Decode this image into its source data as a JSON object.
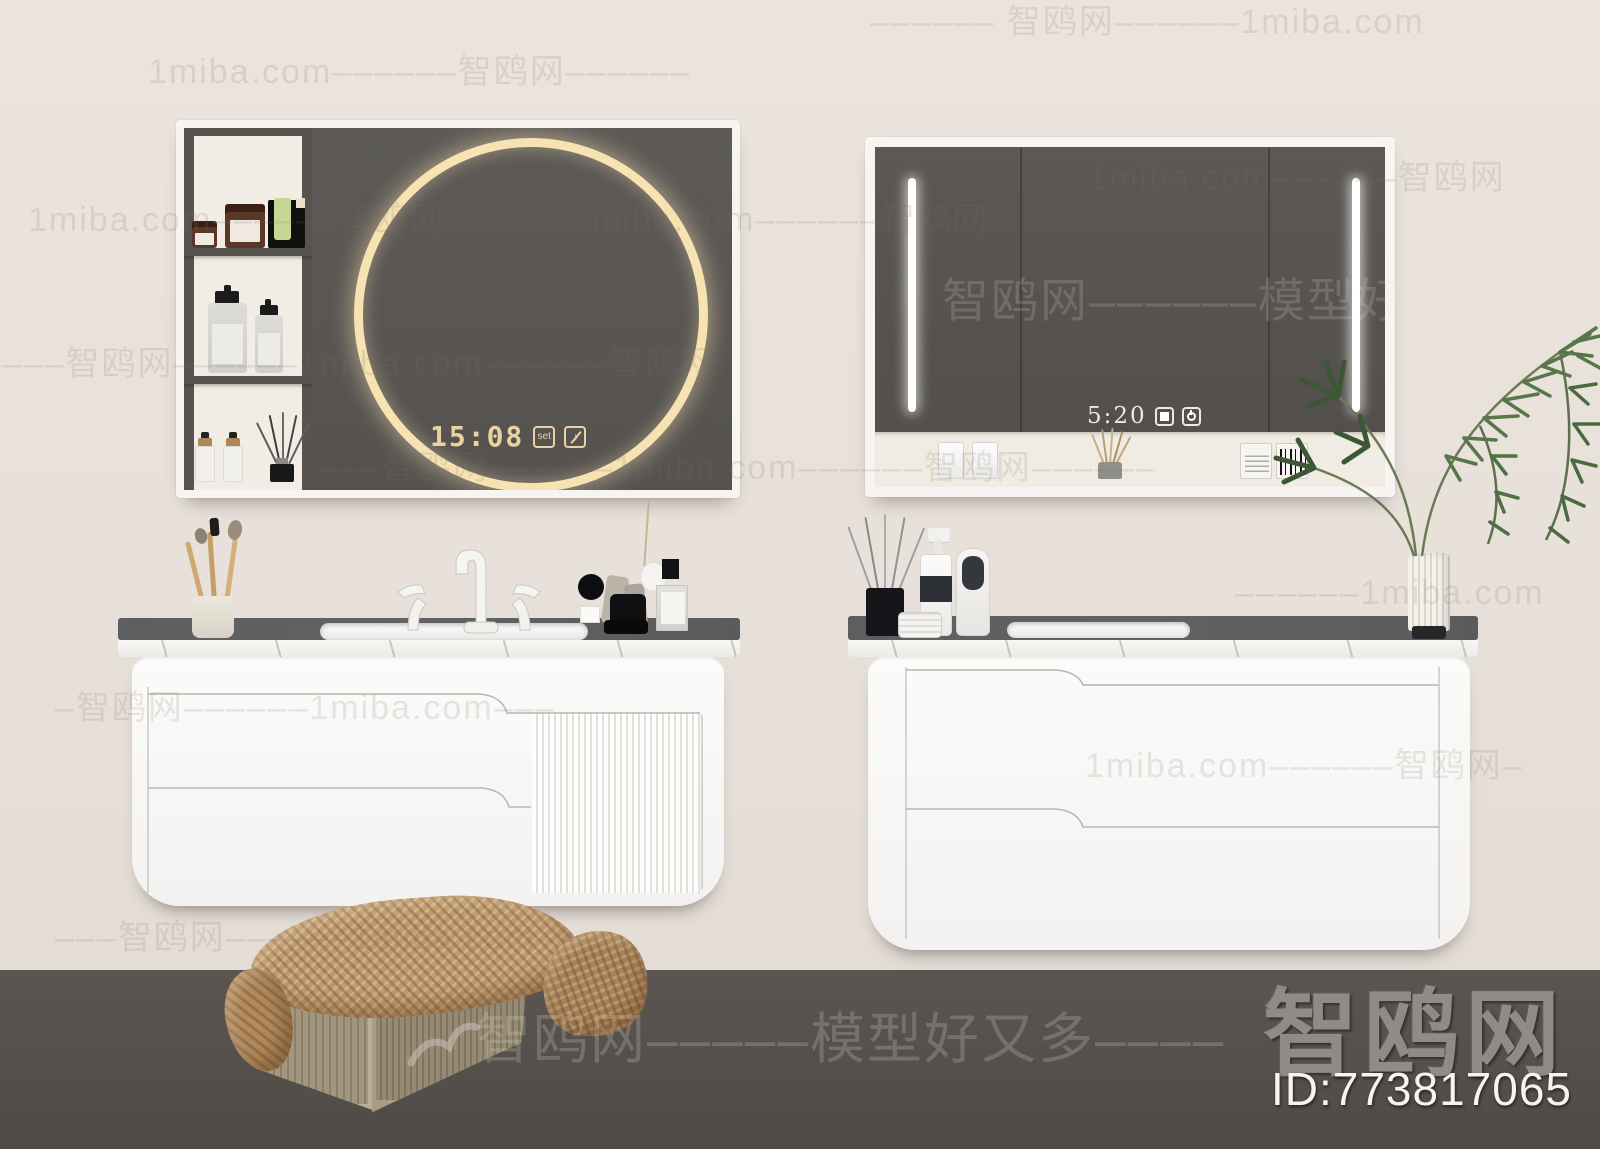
{
  "brand": {
    "site_name": "智鸥网",
    "id_label": "ID:773817065"
  },
  "left_mirror_cabinet": {
    "clock_time": "15:08",
    "set_button_label": "set",
    "music_icon_glyph": "♪"
  },
  "right_mirror_cabinet": {
    "clock_time": "5:20"
  },
  "watermarks": {
    "rows": [
      {
        "text": "–––––– 智鸥网––––––1miba.com"
      },
      {
        "text": "1miba.com––––––智鸥网––––––"
      },
      {
        "text": "1miba.com––––––智鸥网––––––1miba.com––––––智鸥网"
      },
      {
        "text": "1miba.com––––––智鸥网"
      },
      {
        "text": "智鸥网––––––模型好又多––"
      },
      {
        "text": "––––––智鸥网––––––1miba.com––––––智鸥网"
      },
      {
        "text": "–––智鸥网––––––1miba.com––––––智鸥网––––––"
      },
      {
        "text": "––––––1miba.com"
      },
      {
        "text": "–智鸥网––––––1miba.com–––"
      },
      {
        "text": "1miba.com––––––智鸥网–"
      },
      {
        "text": "–––智鸥网––––––1miba.com–––"
      },
      {
        "text": "智鸥网–––––模型好又多––––"
      }
    ]
  },
  "colors": {
    "wall": "#e8e1da",
    "floor": "#544f4b",
    "mirror_glass": "#5a5653",
    "ring_gold": "#f7e2b2",
    "clock_gold": "#ead3a0",
    "led_white": "#ffffff",
    "counter_top": "#5c5e60",
    "cabinet_white": "#fbfbfa",
    "plant_green": "#4f7044",
    "basket_tan": "#b3a78f",
    "blanket_tan": "#c29d72"
  }
}
